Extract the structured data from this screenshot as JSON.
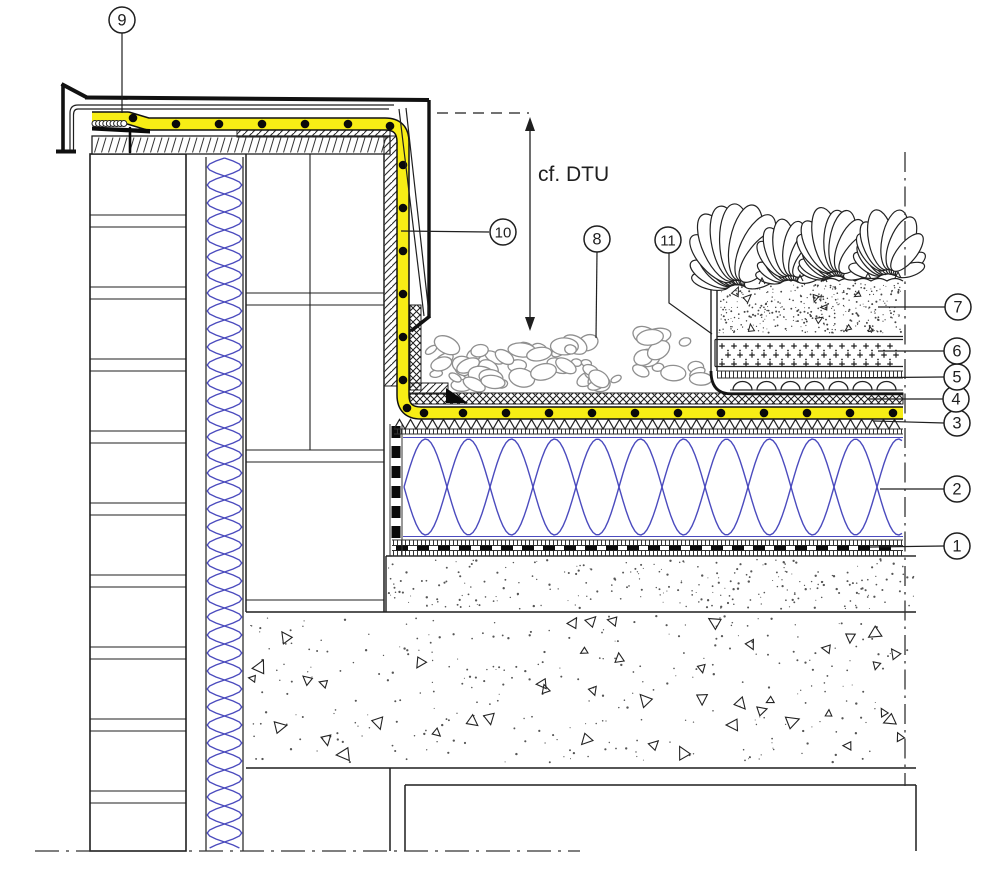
{
  "drawing": {
    "annotation": {
      "label": "cf. DTU",
      "label_x": 538,
      "label_y": 181,
      "arrow_x": 530,
      "arrow_y1": 118,
      "arrow_y2": 330,
      "ref_dash_y": 113,
      "ref_dash_x1": 437,
      "ref_dash_x2": 529
    },
    "callouts": [
      {
        "label": "1",
        "cx": 957,
        "cy": 546,
        "leader": [
          [
            944,
            546
          ],
          [
            870,
            547
          ]
        ]
      },
      {
        "label": "2",
        "cx": 957,
        "cy": 489,
        "leader": [
          [
            944,
            489
          ],
          [
            880,
            489
          ]
        ]
      },
      {
        "label": "3",
        "cx": 957,
        "cy": 423,
        "leader": [
          [
            944,
            423
          ],
          [
            874,
            421
          ]
        ]
      },
      {
        "label": "4",
        "cx": 956,
        "cy": 399,
        "leader": [
          [
            943,
            399
          ],
          [
            868,
            399
          ]
        ]
      },
      {
        "label": "5",
        "cx": 957,
        "cy": 377,
        "leader": [
          [
            944,
            377
          ],
          [
            828,
            378
          ]
        ]
      },
      {
        "label": "6",
        "cx": 957,
        "cy": 351,
        "leader": [
          [
            944,
            351
          ],
          [
            878,
            351
          ]
        ]
      },
      {
        "label": "7",
        "cx": 958,
        "cy": 307,
        "leader": [
          [
            945,
            307
          ],
          [
            878,
            307
          ]
        ]
      },
      {
        "label": "8",
        "cx": 597,
        "cy": 239,
        "leader": [
          [
            597,
            252
          ],
          [
            596,
            338
          ]
        ]
      },
      {
        "label": "9",
        "cx": 122,
        "cy": 20,
        "leader": [
          [
            122,
            33
          ],
          [
            122,
            113
          ]
        ]
      },
      {
        "label": "10",
        "cx": 503,
        "cy": 232,
        "leader": [
          [
            489,
            232
          ],
          [
            401,
            231
          ]
        ]
      },
      {
        "label": "11",
        "cx": 668,
        "cy": 240,
        "leader": [
          [
            669,
            253
          ],
          [
            669,
            303
          ],
          [
            712,
            334
          ]
        ]
      }
    ],
    "colors": {
      "line": "#1f1f1f",
      "heavy": "#111111",
      "membrane_yellow": "#f7ed15",
      "insulation_blue": "#4b4bbe",
      "pebble_grey": "#8f8f8f",
      "speckle_grey": "#555555",
      "background": "#ffffff"
    }
  }
}
